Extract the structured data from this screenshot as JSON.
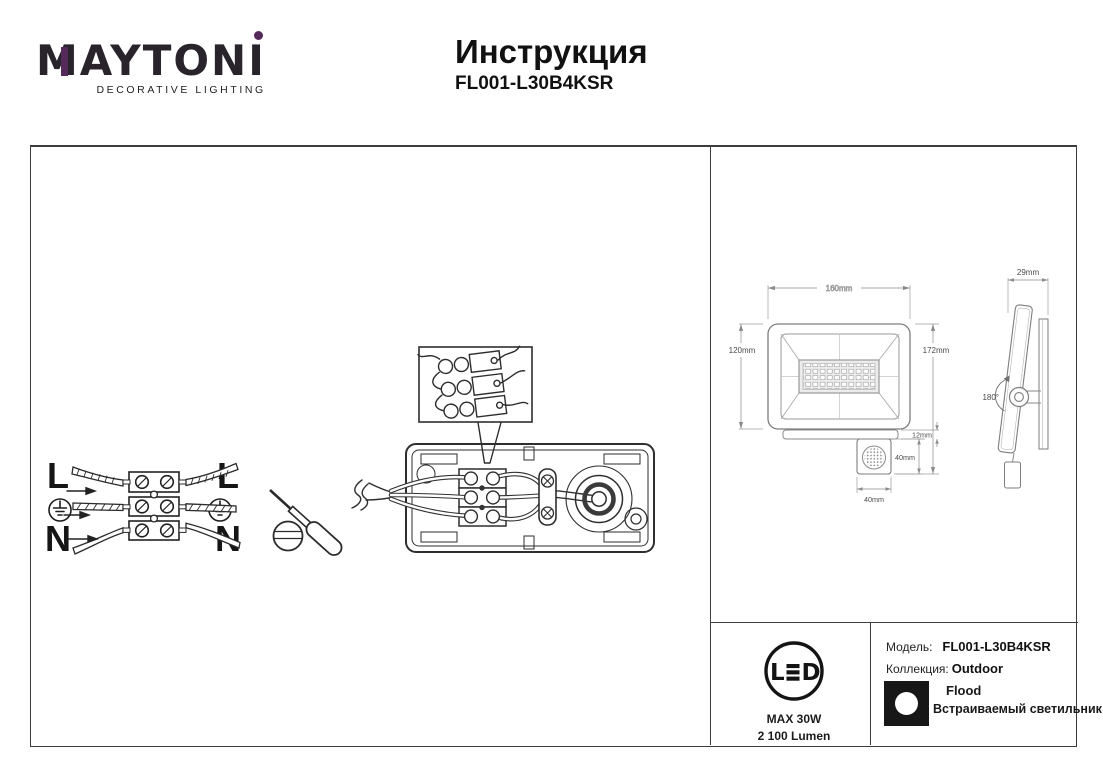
{
  "header": {
    "brand": "MAYTONI",
    "tagline": "DECORATIVE LIGHTING",
    "title": "Инструкция",
    "model": "FL001-L30B4KSR",
    "accent_color": "#542a5a"
  },
  "wiring": {
    "line_label": "L",
    "neutral_label": "N",
    "icons": [
      "ground-icon",
      "terminal-block",
      "screwdriver-icon",
      "junction-box",
      "detail-inset"
    ]
  },
  "dimensions": {
    "body_width": "160mm",
    "body_height": "120mm",
    "total_height": "172mm",
    "bracket_height": "12mm",
    "sensor_height": "40mm",
    "sensor_width": "40mm",
    "depth": "29mm",
    "swivel_angle": "180°"
  },
  "spec": {
    "led_letter_l": "L",
    "led_letter_d": "D",
    "max_power": "MAX 30W",
    "luminous_flux": "2 100 Lumen",
    "model_label": "Модель:",
    "model_value": "FL001-L30B4KSR",
    "collection_label": "Коллекция:",
    "collection_value": "Outdoor",
    "type_value": "Flood",
    "type_description": "Встраиваемый светильник"
  }
}
